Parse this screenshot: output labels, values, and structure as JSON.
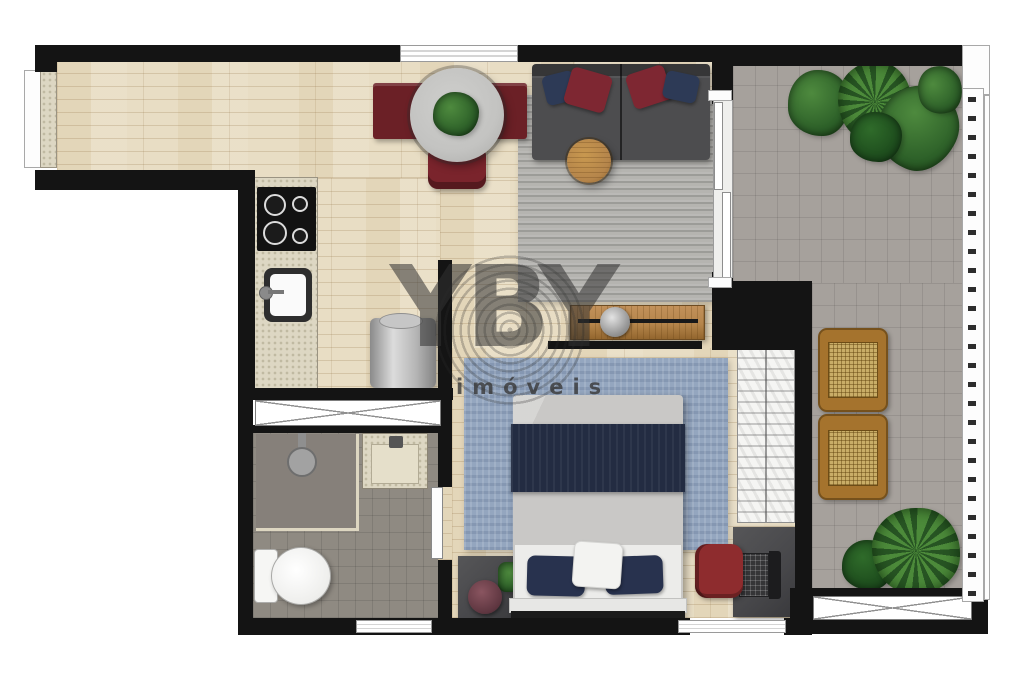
{
  "watermark": {
    "logo": "YBY",
    "subtitle": "imóveis"
  },
  "colors": {
    "wall": "#141414",
    "wood": "#e8ddc4",
    "balcony_floor": "#a6a19c",
    "bath_floor": "#8f8a82",
    "rug_living": "#b5b4b0",
    "rug_bedroom": "#94a6bf",
    "counter": "#ddd7c3",
    "sofa": "#4d4d4f",
    "pillow_navy": "#2d3a56",
    "pillow_red": "#7e2732",
    "dining_seat": "#6b2026",
    "table_gray": "#c3c3c1",
    "wood_furniture": "#b5854b",
    "blanket_navy": "#232c42",
    "sheet_gray": "#c9c8c6",
    "dark_furniture": "#47474a",
    "chair_red": "#8e2c2e",
    "lounger_wood": "#a5732d",
    "rattan": "#c9ad67",
    "plant_dark": "#2c5f28",
    "plant_light": "#4e8a3e",
    "watermark": "#323232"
  },
  "rooms": [
    "entry-corridor",
    "kitchen",
    "dining-living-room",
    "bedroom",
    "bathroom",
    "balcony-terrace"
  ],
  "fixtures": [
    "entry-threshold",
    "top-window",
    "kitchen-counter",
    "cooktop-4-burners",
    "kitchen-sink",
    "washing-machine",
    "storage-cabinet",
    "dining-table",
    "dining-table-plant",
    "dining-bench",
    "dining-chair",
    "sofa-two-modules",
    "sofa-pillows",
    "round-coffee-table",
    "living-rug",
    "tv-console",
    "tv-panel",
    "sliding-balcony-door",
    "balcony-plants",
    "sun-lounger-pair",
    "balcony-railing",
    "balcony-planter-box",
    "bedroom-rug",
    "double-bed",
    "bed-pillows",
    "nightstand",
    "nightstand-plant",
    "decor-tray",
    "wardrobe",
    "desk",
    "laptop",
    "desk-chair",
    "bedroom-window",
    "shower-area",
    "shower-head",
    "bathroom-vanity",
    "toilet",
    "bathroom-door",
    "bathroom-window"
  ]
}
